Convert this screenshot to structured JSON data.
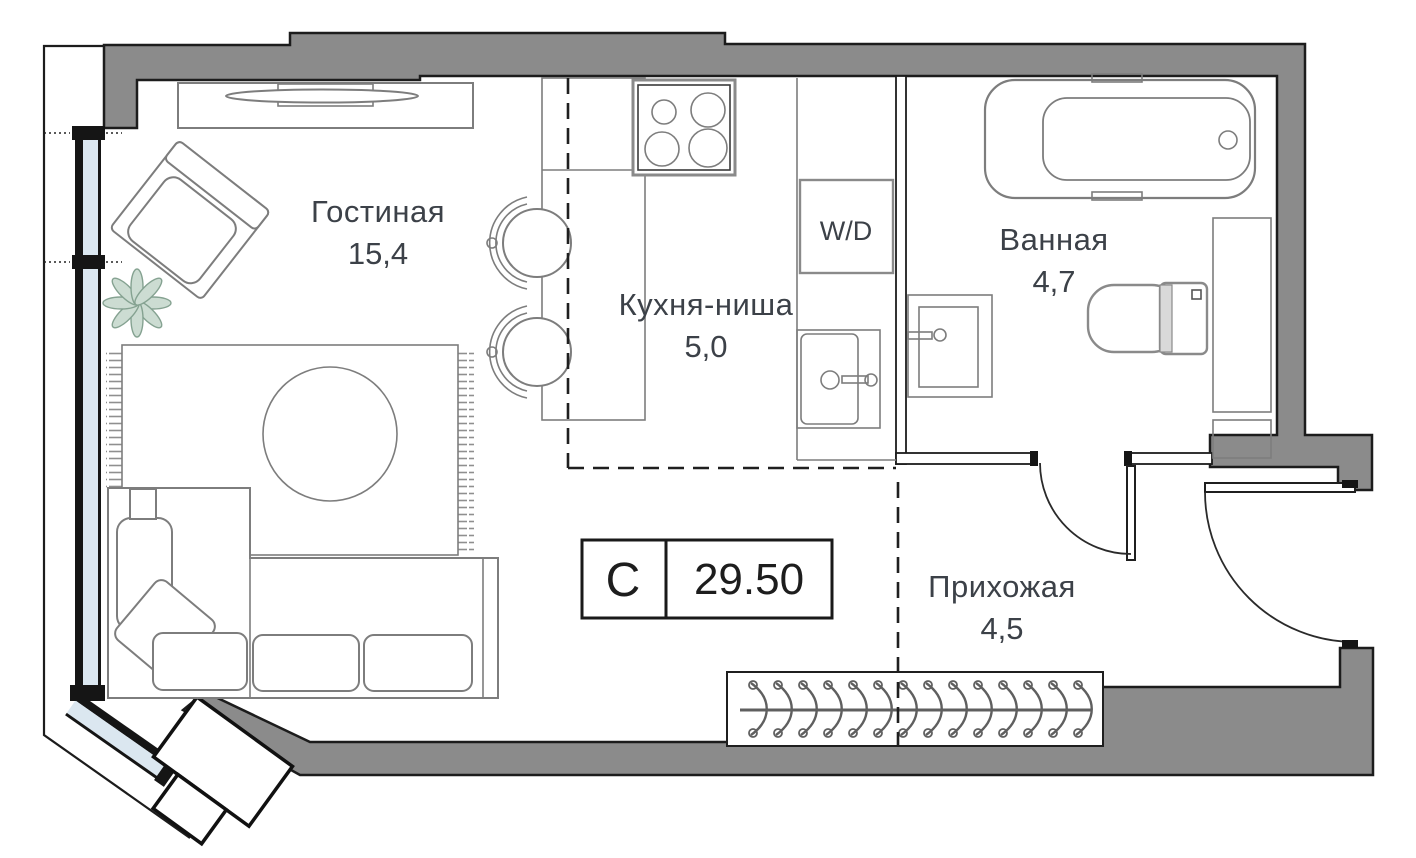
{
  "plan": {
    "unit_type_label": "С",
    "total_area": "29.50",
    "rooms": [
      {
        "name": "Гостиная",
        "area": "15,4"
      },
      {
        "name": "Кухня-ниша",
        "area": "5,0"
      },
      {
        "name": "Ванная",
        "area": "4,7"
      },
      {
        "name": "Прихожая",
        "area": "4,5"
      }
    ],
    "washer_dryer_label": "W/D",
    "colors": {
      "wall": "#8b8b8b",
      "outline": "#1c1c1c",
      "furniture": "#7d7d7d",
      "glass": "#dbe7f0",
      "text": "#3c4148",
      "plant": "#ccdcd2",
      "plant_stroke": "#85a291"
    }
  }
}
